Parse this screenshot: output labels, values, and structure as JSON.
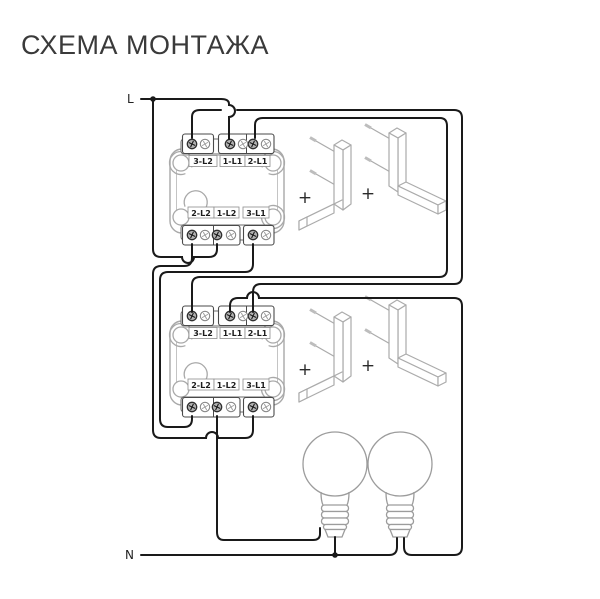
{
  "title": "СХЕМА МОНТАЖА",
  "labels": {
    "line": "L",
    "neutral": "N",
    "plus": "+"
  },
  "switches": [
    {
      "id": "switch-1",
      "top": [
        "3-L2",
        "1-L1",
        "2-L1"
      ],
      "bottom": [
        "2-L2",
        "1-L2",
        "3-L1"
      ]
    },
    {
      "id": "switch-2",
      "top": [
        "3-L2",
        "1-L1",
        "2-L1"
      ],
      "bottom": [
        "2-L2",
        "1-L2",
        "3-L1"
      ]
    }
  ],
  "components": {
    "lamps": 2,
    "led_fixtures": 4,
    "description_items": [
      "two 2-gang switch mechanisms",
      "four L-shaped fixtures",
      "two lamp bulbs"
    ]
  },
  "colors": {
    "wire": "#1a1a1a",
    "device_outline": "#a9a9a9",
    "terminal_outline": "#4a4a4a",
    "label_text": "#1c1c1c",
    "title_text": "#3a3a3a",
    "background": "#ffffff"
  }
}
